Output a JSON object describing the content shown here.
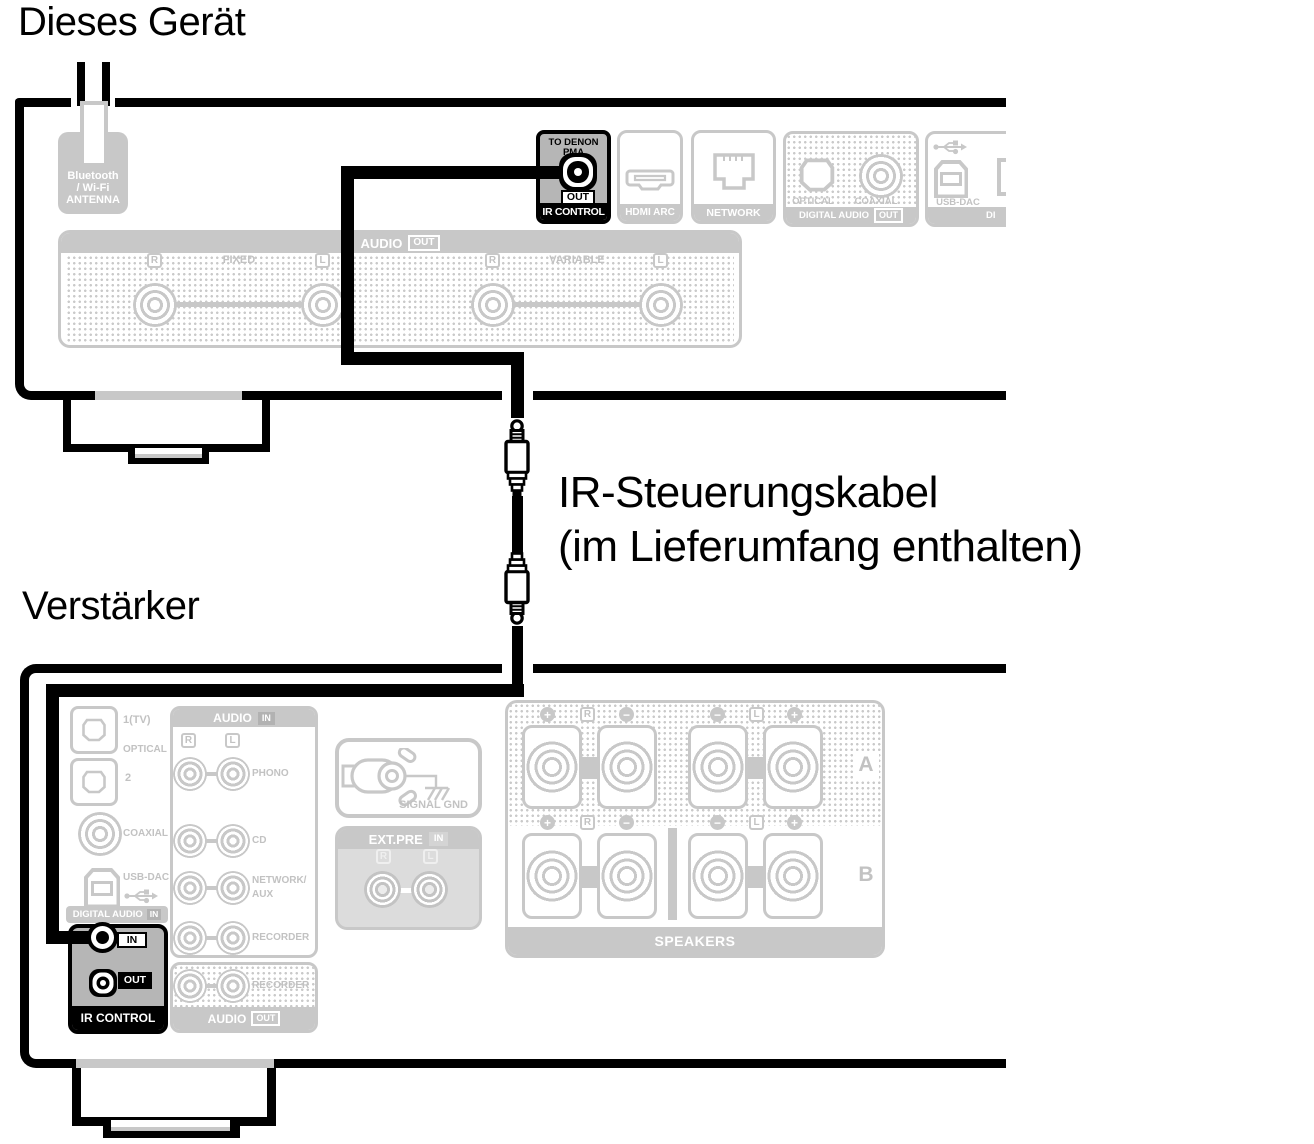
{
  "td": {
    "title": "Dieses Gerät",
    "antenna": {
      "l1": "Bluetooth",
      "l2": "/ Wi-Fi",
      "l3": "ANTENNA"
    },
    "ir": {
      "l1": "TO DENON",
      "l2": "PMA",
      "out": "OUT",
      "label": "IR CONTROL"
    },
    "hdmi": {
      "label": "HDMI ARC"
    },
    "network": {
      "label": "NETWORK"
    },
    "digout": {
      "optical": "OPTICAL",
      "coaxial": "COAXIAL",
      "label": "DIGITAL AUDIO",
      "out": "OUT"
    },
    "usb": {
      "label": "USB-DAC",
      "footer": "DI"
    },
    "audio": {
      "header": "AUDIO",
      "out": "OUT",
      "r1": "R",
      "fixed": "FIXED",
      "l1": "L",
      "r2": "R",
      "variable": "VARIABLE",
      "l2": "L"
    }
  },
  "cable": {
    "l1": "IR-Steuerungskabel",
    "l2": "(im Lieferumfang enthalten)"
  },
  "amp": {
    "title": "Verstärker",
    "din": {
      "t1": "1(TV)",
      "optical": "OPTICAL",
      "t2": "2",
      "coaxial": "COAXIAL",
      "usb": "USB-DAC",
      "label": "DIGITAL AUDIO",
      "badge": "IN"
    },
    "ir": {
      "in": "IN",
      "out": "OUT",
      "label": "IR CONTROL"
    },
    "ain": {
      "header": "AUDIO",
      "badge": "IN",
      "r": "R",
      "l": "L",
      "row1": "PHONO",
      "row2": "CD",
      "row3a": "NETWORK/",
      "row3b": "AUX",
      "row4": "RECORDER"
    },
    "aout": {
      "rec": "RECORDER",
      "label": "AUDIO",
      "badge": "OUT"
    },
    "gnd": {
      "label": "SIGNAL GND"
    },
    "extpre": {
      "header": "EXT.PRE",
      "badge": "IN",
      "r": "R",
      "l": "L"
    },
    "spk": {
      "a_plus": "+",
      "a_r": "R",
      "a_minus": "−",
      "a_minus2": "−",
      "a_l": "L",
      "a_plus2": "+",
      "a": "A",
      "b_plus": "+",
      "b_r": "R",
      "b_minus": "−",
      "b_minus2": "−",
      "b_l": "L",
      "b_plus2": "+",
      "b": "B",
      "label": "SPEAKERS"
    }
  },
  "colors": {
    "black": "#000000",
    "gray_line": "#c8c8c8",
    "gray_text": "#c2c2c2",
    "gray_dark": "#b6b6b6",
    "white": "#ffffff"
  }
}
